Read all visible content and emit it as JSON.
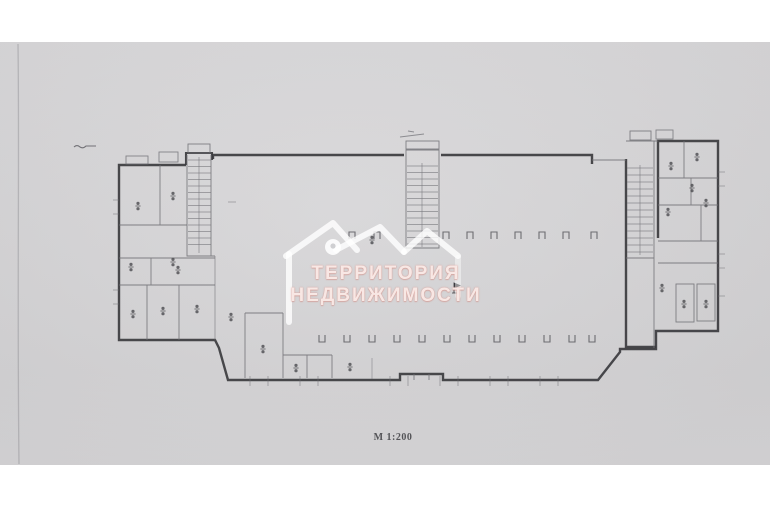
{
  "document": {
    "kind": "scanned floor plan photo",
    "scale_label": "М 1:200"
  },
  "watermark": {
    "title": "ТЕРРИТОРИЯ",
    "subtitle": "НЕДВИЖИМОСТИ",
    "logo": "house-roofline-with-location-pin-icon"
  },
  "colors": {
    "page_bg": "#ffffff",
    "paper": "#d5d4d6",
    "wall_line": "#3b3b3e",
    "partition_line": "#6e6e73",
    "watermark_white": "#ffffff",
    "watermark_text_tint": "#d98f86",
    "scale_text": "#3e3e42"
  }
}
